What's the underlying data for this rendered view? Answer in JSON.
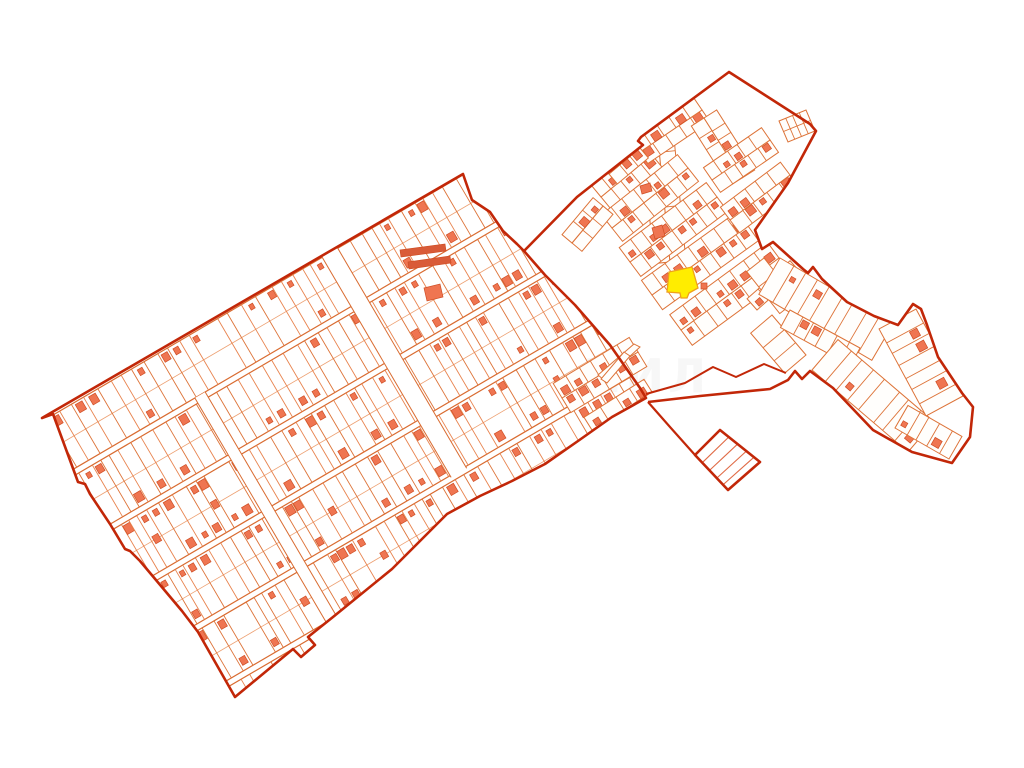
{
  "map": {
    "width": 1024,
    "height": 768,
    "bg": "#ffffff",
    "colors": {
      "boundary": "#c22708",
      "parcel": "#dd7338",
      "parcel_alt": "#e8834e",
      "parcel_light": "#eda072",
      "road_edge": "#d96b30",
      "building": "#ef7551",
      "building_edge": "#cf4f26",
      "selected_fill": "#ffed00",
      "selected_stroke": "#efa11a",
      "mask": "#fffefc",
      "diamond_line": "#e06a45",
      "watermark": "#d9d9d9"
    },
    "main_region": {
      "points": [
        [
          42,
          418
        ],
        [
          463,
          174
        ],
        [
          472,
          200
        ],
        [
          490,
          212
        ],
        [
          503,
          231
        ],
        [
          517,
          244
        ],
        [
          524,
          251
        ],
        [
          545,
          275
        ],
        [
          575,
          305
        ],
        [
          610,
          345
        ],
        [
          640,
          388
        ],
        [
          646,
          398
        ],
        [
          612,
          417
        ],
        [
          578,
          441
        ],
        [
          545,
          464
        ],
        [
          512,
          481
        ],
        [
          480,
          496
        ],
        [
          447,
          514
        ],
        [
          400,
          561
        ],
        [
          392,
          569
        ],
        [
          333,
          617
        ],
        [
          308,
          637
        ],
        [
          315,
          645
        ],
        [
          301,
          657
        ],
        [
          293,
          649
        ],
        [
          235,
          697
        ],
        [
          198,
          632
        ],
        [
          182,
          611
        ],
        [
          140,
          561
        ],
        [
          130,
          551
        ],
        [
          125,
          549
        ],
        [
          110,
          524
        ],
        [
          90,
          494
        ],
        [
          85,
          484
        ],
        [
          78,
          482
        ],
        [
          53,
          414
        ]
      ]
    },
    "grid": {
      "origin": [
        42,
        418
      ],
      "u": [
        0.8629,
        -0.5054
      ],
      "xmax": 540,
      "bands": [
        [
          3,
          60
        ],
        [
          66,
          126
        ],
        [
          132,
          192
        ],
        [
          198,
          256
        ],
        [
          262,
          320
        ],
        [
          326,
          338
        ]
      ],
      "crossroads": [
        {
          "x": 148,
          "w": 6,
          "y0": 60,
          "y1": 322
        },
        {
          "x": 332,
          "w": 9,
          "y0": 0,
          "y1": 258
        }
      ],
      "seed": 7
    },
    "village_boundary": {
      "points": [
        [
          524,
          251
        ],
        [
          577,
          197
        ],
        [
          643,
          145
        ],
        [
          638,
          141
        ],
        [
          641,
          137
        ],
        [
          729,
          72
        ],
        [
          810,
          124
        ],
        [
          816,
          131
        ],
        [
          788,
          183
        ],
        [
          755,
          230
        ],
        [
          762,
          249
        ],
        [
          773,
          242
        ],
        [
          803,
          269
        ],
        [
          808,
          273
        ],
        [
          813,
          267
        ],
        [
          822,
          279
        ],
        [
          847,
          302
        ],
        [
          874,
          316
        ],
        [
          898,
          325
        ],
        [
          913,
          304
        ],
        [
          921,
          309
        ],
        [
          927,
          325
        ],
        [
          938,
          357
        ],
        [
          962,
          393
        ],
        [
          973,
          407
        ],
        [
          970,
          437
        ],
        [
          952,
          463
        ],
        [
          912,
          452
        ],
        [
          873,
          430
        ],
        [
          833,
          388
        ],
        [
          810,
          371
        ],
        [
          802,
          379
        ],
        [
          795,
          371
        ],
        [
          788,
          380
        ],
        [
          770,
          389
        ],
        [
          700,
          396
        ],
        [
          648,
          402
        ]
      ]
    },
    "corridor": {
      "points": [
        [
          646,
          394
        ],
        [
          685,
          383
        ],
        [
          713,
          367
        ],
        [
          736,
          377
        ],
        [
          764,
          364
        ],
        [
          786,
          373
        ]
      ]
    },
    "connector": {
      "points": [
        [
          648,
          402
        ],
        [
          670,
          427
        ],
        [
          695,
          455
        ]
      ]
    },
    "diamond": {
      "points": [
        [
          720,
          430
        ],
        [
          760,
          462
        ],
        [
          728,
          490
        ],
        [
          695,
          455
        ]
      ],
      "line_ts": [
        0.22,
        0.44,
        0.66,
        0.85
      ]
    },
    "mini_block": {
      "points": [
        [
          779,
          121
        ],
        [
          806,
          110
        ],
        [
          815,
          131
        ],
        [
          788,
          142
        ]
      ],
      "cols": 4
    },
    "lot_rows": [
      {
        "a": [
          656,
          118
        ],
        "b": [
          670,
          262
        ],
        "d": 16,
        "sides": [
          1,
          -1
        ],
        "lots": 8,
        "seed": 23,
        "bp": 0.35,
        "clip": "v"
      },
      {
        "a": [
          601,
          197
        ],
        "b": [
          652,
          155
        ],
        "d": 16,
        "sides": [
          1,
          -1
        ],
        "lots": 5,
        "seed": 11,
        "bp": 0.5,
        "clip": "v"
      },
      {
        "a": [
          612,
          228
        ],
        "b": [
          688,
          168
        ],
        "d": 17,
        "sides": [
          1,
          -1
        ],
        "lots": 7,
        "seed": 12,
        "bp": 0.5,
        "clip": "v"
      },
      {
        "a": [
          630,
          262
        ],
        "b": [
          717,
          197
        ],
        "d": 18,
        "sides": [
          1,
          -1
        ],
        "lots": 8,
        "seed": 13,
        "bp": 0.5,
        "clip": "v"
      },
      {
        "a": [
          652,
          295
        ],
        "b": [
          748,
          226
        ],
        "d": 18,
        "sides": [
          1,
          -1
        ],
        "lots": 8,
        "seed": 14,
        "bp": 0.5,
        "clip": "v"
      },
      {
        "a": [
          681,
          330
        ],
        "b": [
          779,
          258
        ],
        "d": 19,
        "sides": [
          1,
          -1
        ],
        "lots": 8,
        "seed": 15,
        "bp": 0.5,
        "clip": "v"
      },
      {
        "a": [
          757,
          310
        ],
        "b": [
          800,
          272
        ],
        "d": 15,
        "sides": [
          -1
        ],
        "lots": 4,
        "seed": 16,
        "bp": 0.45,
        "clip": "v"
      },
      {
        "a": [
          640,
          152
        ],
        "b": [
          702,
          110
        ],
        "d": 14,
        "sides": [
          1,
          -1
        ],
        "lots": 5,
        "seed": 17,
        "bp": 0.45,
        "clip": "v"
      },
      {
        "a": [
          609,
          174
        ],
        "b": [
          640,
          148
        ],
        "d": 13,
        "sides": [
          1,
          -1
        ],
        "lots": 3,
        "seed": 18,
        "bp": 0.45,
        "clip": "v"
      },
      {
        "a": [
          572,
          243
        ],
        "b": [
          603,
          206
        ],
        "d": 13,
        "sides": [
          1,
          -1
        ],
        "lots": 3,
        "seed": 19,
        "bp": 0.45,
        "clip": "v"
      },
      {
        "a": [
          704,
          118
        ],
        "b": [
          742,
          178
        ],
        "d": 15,
        "sides": [
          1,
          -1
        ],
        "lots": 5,
        "seed": 20,
        "bp": 0.4,
        "clip": "v"
      },
      {
        "a": [
          712,
          180
        ],
        "b": [
          770,
          140
        ],
        "d": 15,
        "sides": [
          1,
          -1
        ],
        "lots": 5,
        "seed": 21,
        "bp": 0.45,
        "clip": "v"
      },
      {
        "a": [
          730,
          220
        ],
        "b": [
          790,
          175
        ],
        "d": 16,
        "sides": [
          1,
          -1
        ],
        "lots": 5,
        "seed": 22,
        "bp": 0.45,
        "clip": "v"
      },
      {
        "a": [
          764,
          258
        ],
        "b": [
          797,
          300
        ],
        "d": 22,
        "sides": [
          1
        ],
        "lots": 3,
        "seed": 26,
        "bp": 0.4,
        "clip": "v"
      },
      {
        "a": [
          772,
          315
        ],
        "b": [
          806,
          355
        ],
        "d": 28,
        "sides": [
          1
        ],
        "lots": 3,
        "seed": 27,
        "bp": 0.3,
        "clip": "v"
      },
      {
        "a": [
          780,
          258
        ],
        "b": [
          893,
          324
        ],
        "d": 42,
        "sides": [
          1
        ],
        "lots": 9,
        "seed": 28,
        "bp": 0.45,
        "clip": "v"
      },
      {
        "a": [
          790,
          310
        ],
        "b": [
          860,
          348
        ],
        "d": 20,
        "sides": [
          1
        ],
        "lots": 6,
        "seed": 29,
        "bp": 0.5,
        "clip": "v"
      },
      {
        "a": [
          812,
          370
        ],
        "b": [
          908,
          452
        ],
        "d": 40,
        "sides": [
          -1
        ],
        "lots": 8,
        "seed": 30,
        "bp": 0.5,
        "clip": "v"
      },
      {
        "a": [
          916,
          309
        ],
        "b": [
          963,
          396
        ],
        "d": 42,
        "sides": [
          1
        ],
        "lots": 7,
        "seed": 31,
        "bp": 0.45,
        "clip": "v"
      },
      {
        "a": [
          895,
          428
        ],
        "b": [
          949,
          459
        ],
        "d": 26,
        "sides": [
          -1
        ],
        "lots": 5,
        "seed": 32,
        "bp": 0.4,
        "clip": "v"
      },
      {
        "a": [
          562,
          398
        ],
        "b": [
          638,
          352
        ],
        "d": 17,
        "sides": [
          1,
          -1
        ],
        "lots": 6,
        "seed": 24,
        "bp": 0.4,
        "clip": "none"
      },
      {
        "a": [
          592,
          430
        ],
        "b": [
          652,
          392
        ],
        "d": 15,
        "sides": [
          -1
        ],
        "lots": 4,
        "seed": 25,
        "bp": 0.4,
        "clip": "none"
      }
    ],
    "darts": [
      [
        [
          640,
          347
        ],
        [
          604,
          380
        ],
        [
          598,
          375
        ],
        [
          634,
          344
        ]
      ],
      [
        [
          630,
          356
        ],
        [
          607,
          383
        ],
        [
          601,
          379
        ],
        [
          624,
          352
        ]
      ]
    ],
    "extra_buildings": [
      {
        "points": [
          [
            424,
            288
          ],
          [
            440,
            284
          ],
          [
            443,
            297
          ],
          [
            427,
            301
          ]
        ],
        "c": "#ef7551"
      },
      {
        "points": [
          [
            400,
            250
          ],
          [
            445,
            244
          ],
          [
            446,
            251
          ],
          [
            401,
            257
          ]
        ],
        "c": "#d95b38"
      },
      {
        "points": [
          [
            408,
            262
          ],
          [
            450,
            256
          ],
          [
            451,
            263
          ],
          [
            409,
            269
          ]
        ],
        "c": "#d95b38"
      },
      {
        "points": [
          [
            701,
            283
          ],
          [
            707,
            283
          ],
          [
            707,
            289
          ],
          [
            701,
            289
          ]
        ],
        "c": "#ef7551"
      },
      {
        "points": [
          [
            652,
            228
          ],
          [
            662,
            225
          ],
          [
            665,
            236
          ],
          [
            655,
            239
          ]
        ],
        "c": "#ef7551"
      },
      {
        "points": [
          [
            640,
            186
          ],
          [
            650,
            183
          ],
          [
            652,
            191
          ],
          [
            642,
            194
          ]
        ],
        "c": "#ef7551"
      }
    ],
    "selected_parcel": {
      "points": [
        [
          669,
          272
        ],
        [
          692,
          267
        ],
        [
          698,
          288
        ],
        [
          689,
          293
        ],
        [
          687,
          298
        ],
        [
          681,
          298
        ],
        [
          680,
          293
        ],
        [
          667,
          292
        ]
      ]
    },
    "watermark": {
      "text": "НИЛ",
      "x": 583,
      "y": 392,
      "size": 46,
      "opacity": 0.2
    }
  }
}
